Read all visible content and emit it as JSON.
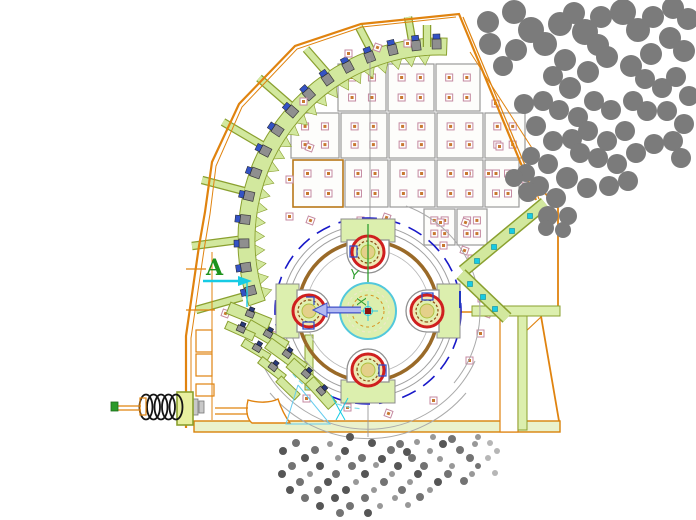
{
  "labels": {
    "datum": "A",
    "axis_x": "X",
    "axis_y": "Y"
  },
  "colors": {
    "casing_orange": "#e0830f",
    "liner_green_fill": "#d2e89e",
    "liner_green_stroke": "#8aa02f",
    "block_green": "#dcefae",
    "bearing_red": "#cf1f1f",
    "rotor_brown": "#9a6a28",
    "pitch_blue": "#1818c8",
    "cyan_accent": "#17cbe4",
    "lavender_arrow": "#b2baf2",
    "arrow_edge_blue": "#4050c8",
    "rock_gray": "#7b7b7b",
    "axis_green": "#2f9e2f",
    "plate_stroke": "#9a9a9a",
    "bolt_square_stroke": "#c489a0",
    "bolt_square_core": "#c87830",
    "bolt_body_gray": "#8f8f8f",
    "bolt_cap_blue": "#3352c4"
  },
  "drawing": {
    "band": {
      "cx": 440,
      "cy": 240,
      "r_in": 185,
      "r_out": 202,
      "deg_start": 163.5,
      "deg_end": 269.5
    },
    "liner_bolt_angles": [
      165,
      172,
      179,
      186,
      193,
      200,
      207,
      214,
      221,
      228,
      235,
      242,
      249,
      256,
      263,
      269
    ],
    "ribs": [
      [
        242,
        297,
        196,
        310
      ],
      [
        238,
        240,
        192,
        246
      ],
      [
        244,
        191,
        202,
        180
      ],
      [
        262,
        145,
        223,
        122
      ],
      [
        290,
        105,
        259,
        78
      ],
      [
        327,
        73,
        306,
        49
      ],
      [
        371,
        50,
        359,
        27
      ],
      [
        412,
        40,
        408,
        17
      ],
      [
        427,
        47,
        427,
        25
      ]
    ],
    "plates": [
      [
        338,
        64,
        48,
        47,
        0
      ],
      [
        388,
        64,
        46,
        47,
        0
      ],
      [
        436,
        64,
        44,
        47,
        0
      ],
      [
        291,
        113,
        48,
        45,
        0
      ],
      [
        341,
        113,
        46,
        45,
        0
      ],
      [
        389,
        113,
        46,
        45,
        0
      ],
      [
        437,
        113,
        46,
        45,
        0
      ],
      [
        485,
        113,
        40,
        45,
        0
      ],
      [
        293,
        160,
        50,
        47,
        1
      ],
      [
        345,
        160,
        43,
        47,
        0
      ],
      [
        390,
        160,
        45,
        47,
        0
      ],
      [
        437,
        160,
        46,
        47,
        0
      ],
      [
        485,
        160,
        34,
        47,
        0
      ],
      [
        424,
        209,
        31,
        36,
        0
      ],
      [
        457,
        209,
        30,
        36,
        0
      ]
    ],
    "lone_squares": [
      [
        345,
        50
      ],
      [
        374,
        44
      ],
      [
        404,
        40
      ],
      [
        300,
        98
      ],
      [
        306,
        144
      ],
      [
        286,
        176
      ],
      [
        286,
        213
      ],
      [
        307,
        217
      ],
      [
        357,
        217
      ],
      [
        437,
        219
      ],
      [
        462,
        219
      ],
      [
        492,
        100
      ],
      [
        496,
        143
      ],
      [
        383,
        214
      ],
      [
        440,
        242
      ],
      [
        468,
        255
      ],
      [
        484,
        310
      ],
      [
        466,
        357
      ],
      [
        430,
        397
      ],
      [
        385,
        410
      ],
      [
        344,
        404
      ],
      [
        303,
        395
      ],
      [
        271,
        332
      ],
      [
        463,
        170
      ],
      [
        485,
        170
      ],
      [
        461,
        247
      ],
      [
        478,
        295
      ],
      [
        477,
        330
      ],
      [
        222,
        310
      ],
      [
        522,
        176
      ]
    ],
    "left_apron_plates": [
      [
        249,
        316,
        22,
        44,
        12
      ],
      [
        267,
        336,
        30,
        44,
        12
      ],
      [
        286,
        356,
        36,
        44,
        12
      ],
      [
        305,
        376,
        42,
        40,
        12
      ],
      [
        321,
        393,
        48,
        34,
        11
      ],
      [
        240,
        331,
        24,
        30,
        8
      ],
      [
        256,
        350,
        31,
        30,
        8
      ],
      [
        272,
        369,
        38,
        30,
        8
      ],
      [
        288,
        388,
        44,
        26,
        8
      ]
    ],
    "left_apron_bolts": [
      [
        250,
        314,
        22
      ],
      [
        268,
        334,
        30
      ],
      [
        287,
        354,
        36
      ],
      [
        306,
        374,
        42
      ],
      [
        321,
        391,
        48
      ],
      [
        241,
        329,
        24
      ],
      [
        257,
        348,
        31
      ],
      [
        273,
        367,
        38
      ]
    ],
    "right_apron_bolts": [
      [
        530,
        216
      ],
      [
        512,
        231
      ],
      [
        494,
        247
      ],
      [
        477,
        261
      ],
      [
        470,
        284
      ],
      [
        483,
        297
      ],
      [
        495,
        309
      ]
    ],
    "hammer_rotations": [
      0,
      90,
      180,
      270
    ],
    "rotor": {
      "cx": 368,
      "cy": 311
    },
    "rocks": [
      [
        488,
        22,
        11
      ],
      [
        490,
        44,
        11
      ],
      [
        514,
        12,
        12
      ],
      [
        531,
        30,
        13
      ],
      [
        516,
        50,
        11
      ],
      [
        503,
        66,
        10
      ],
      [
        545,
        44,
        12
      ],
      [
        560,
        24,
        12
      ],
      [
        574,
        13,
        11
      ],
      [
        585,
        32,
        13
      ],
      [
        601,
        17,
        11
      ],
      [
        598,
        45,
        11
      ],
      [
        565,
        60,
        11
      ],
      [
        553,
        76,
        10
      ],
      [
        570,
        88,
        11
      ],
      [
        588,
        72,
        11
      ],
      [
        607,
        57,
        11
      ],
      [
        623,
        12,
        13
      ],
      [
        638,
        30,
        12
      ],
      [
        653,
        17,
        11
      ],
      [
        673,
        8,
        11
      ],
      [
        688,
        19,
        11
      ],
      [
        670,
        38,
        11
      ],
      [
        684,
        51,
        11
      ],
      [
        651,
        54,
        11
      ],
      [
        631,
        66,
        11
      ],
      [
        645,
        79,
        10
      ],
      [
        662,
        88,
        10
      ],
      [
        676,
        77,
        10
      ],
      [
        689,
        96,
        10
      ],
      [
        633,
        101,
        10
      ],
      [
        611,
        110,
        10
      ],
      [
        594,
        101,
        10
      ],
      [
        578,
        117,
        10
      ],
      [
        559,
        110,
        10
      ],
      [
        543,
        101,
        10
      ],
      [
        524,
        104,
        10
      ],
      [
        536,
        126,
        10
      ],
      [
        553,
        141,
        10
      ],
      [
        572,
        139,
        10
      ],
      [
        588,
        131,
        10
      ],
      [
        607,
        141,
        10
      ],
      [
        625,
        131,
        10
      ],
      [
        647,
        111,
        10
      ],
      [
        667,
        111,
        10
      ],
      [
        684,
        124,
        10
      ],
      [
        673,
        141,
        10
      ],
      [
        654,
        144,
        10
      ],
      [
        636,
        153,
        10
      ],
      [
        617,
        164,
        10
      ],
      [
        598,
        158,
        10
      ],
      [
        580,
        153,
        10
      ],
      [
        548,
        164,
        10
      ],
      [
        531,
        156,
        9
      ],
      [
        567,
        178,
        11
      ],
      [
        587,
        188,
        10
      ],
      [
        609,
        186,
        10
      ],
      [
        628,
        181,
        10
      ],
      [
        539,
        186,
        10
      ],
      [
        556,
        198,
        10
      ],
      [
        526,
        173,
        9
      ],
      [
        681,
        158,
        10
      ],
      [
        548,
        216,
        10
      ],
      [
        568,
        216,
        9
      ],
      [
        528,
        192,
        10
      ],
      [
        514,
        178,
        9
      ],
      [
        546,
        228,
        8
      ],
      [
        563,
        230,
        8
      ]
    ],
    "particles": [
      [
        350,
        437,
        4,
        0
      ],
      [
        433,
        437,
        3,
        2
      ],
      [
        452,
        439,
        4,
        1
      ],
      [
        478,
        437,
        3,
        2
      ],
      [
        296,
        443,
        4,
        1
      ],
      [
        330,
        444,
        3,
        2
      ],
      [
        372,
        443,
        4,
        0
      ],
      [
        400,
        444,
        4,
        1
      ],
      [
        417,
        442,
        3,
        2
      ],
      [
        443,
        444,
        4,
        0
      ],
      [
        475,
        444,
        3,
        2
      ],
      [
        490,
        443,
        3,
        3
      ],
      [
        283,
        451,
        4,
        0
      ],
      [
        315,
        450,
        4,
        1
      ],
      [
        345,
        451,
        4,
        0
      ],
      [
        391,
        450,
        4,
        1
      ],
      [
        407,
        452,
        4,
        0
      ],
      [
        430,
        451,
        3,
        2
      ],
      [
        460,
        450,
        4,
        1
      ],
      [
        497,
        451,
        3,
        3
      ],
      [
        305,
        458,
        4,
        0
      ],
      [
        338,
        458,
        3,
        2
      ],
      [
        362,
        458,
        4,
        1
      ],
      [
        382,
        459,
        4,
        0
      ],
      [
        412,
        458,
        4,
        1
      ],
      [
        440,
        459,
        3,
        2
      ],
      [
        470,
        458,
        4,
        1
      ],
      [
        488,
        458,
        3,
        3
      ],
      [
        292,
        466,
        4,
        1
      ],
      [
        320,
        466,
        4,
        0
      ],
      [
        352,
        466,
        4,
        1
      ],
      [
        376,
        465,
        3,
        2
      ],
      [
        398,
        466,
        4,
        0
      ],
      [
        424,
        466,
        4,
        1
      ],
      [
        452,
        466,
        3,
        2
      ],
      [
        478,
        466,
        3,
        1
      ],
      [
        282,
        474,
        4,
        0
      ],
      [
        310,
        474,
        3,
        2
      ],
      [
        336,
        474,
        4,
        1
      ],
      [
        365,
        474,
        4,
        0
      ],
      [
        392,
        474,
        3,
        2
      ],
      [
        418,
        474,
        4,
        0
      ],
      [
        448,
        474,
        4,
        1
      ],
      [
        472,
        474,
        3,
        2
      ],
      [
        495,
        473,
        3,
        3
      ],
      [
        300,
        482,
        4,
        1
      ],
      [
        328,
        482,
        4,
        0
      ],
      [
        356,
        482,
        3,
        2
      ],
      [
        384,
        482,
        4,
        1
      ],
      [
        410,
        482,
        3,
        2
      ],
      [
        438,
        482,
        4,
        0
      ],
      [
        464,
        481,
        4,
        1
      ],
      [
        290,
        490,
        4,
        0
      ],
      [
        318,
        490,
        4,
        1
      ],
      [
        346,
        490,
        4,
        0
      ],
      [
        374,
        490,
        3,
        2
      ],
      [
        402,
        490,
        4,
        1
      ],
      [
        430,
        490,
        3,
        2
      ],
      [
        305,
        498,
        4,
        1
      ],
      [
        335,
        498,
        4,
        0
      ],
      [
        365,
        498,
        4,
        1
      ],
      [
        395,
        498,
        3,
        2
      ],
      [
        420,
        497,
        4,
        1
      ],
      [
        320,
        506,
        4,
        0
      ],
      [
        350,
        506,
        4,
        1
      ],
      [
        380,
        506,
        3,
        2
      ],
      [
        408,
        505,
        3,
        2
      ],
      [
        340,
        513,
        4,
        1
      ],
      [
        368,
        513,
        4,
        0
      ]
    ],
    "particle_palette": [
      "#565656",
      "#737373",
      "#989898",
      "#b6b6b6"
    ]
  }
}
